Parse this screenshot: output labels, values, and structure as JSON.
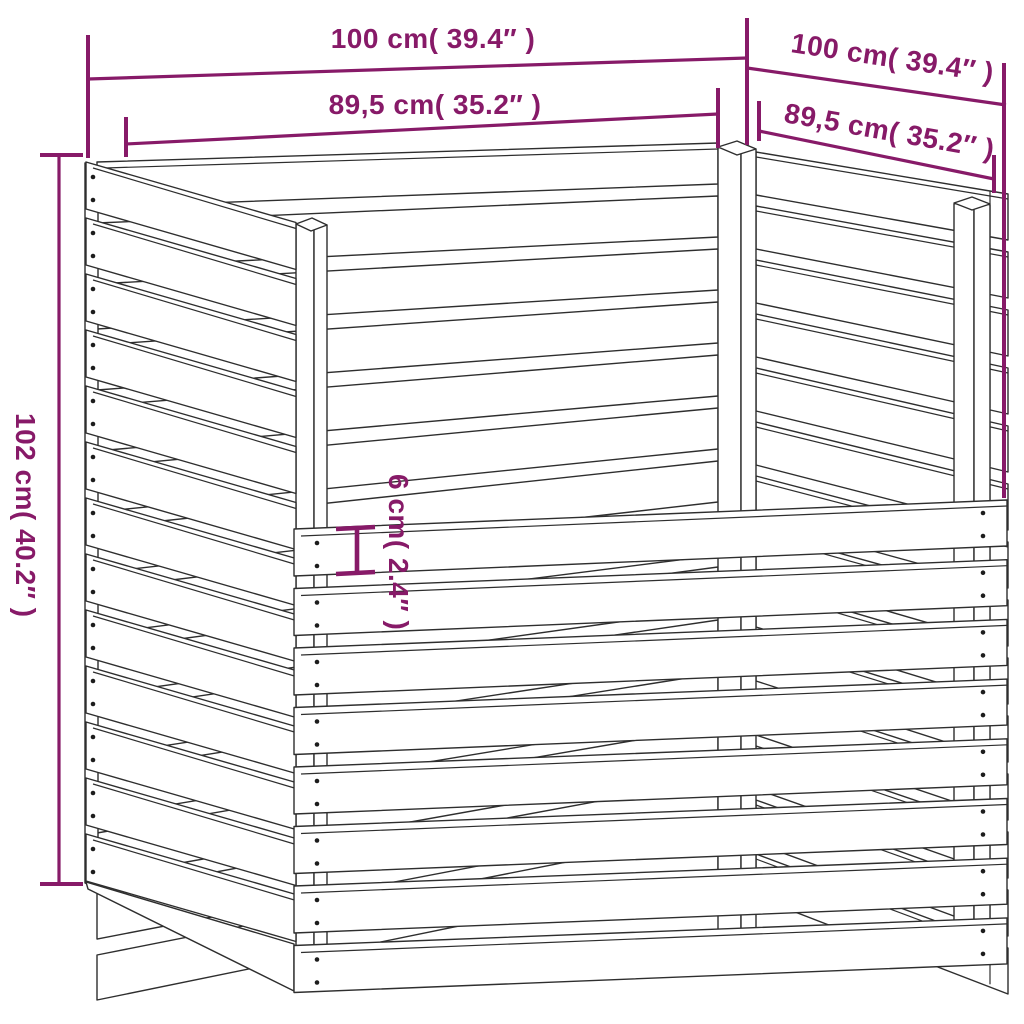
{
  "diagram": {
    "kind": "product-dimension-drawing",
    "subject": "wooden slatted composter, perspective line drawing",
    "background_color": "#ffffff",
    "colors": {
      "dimension_accent": "#871a68",
      "outline": "#2e2e2e"
    },
    "labels": {
      "back_width": "100 cm( 39.4″ )",
      "back_inner_width": "89,5 cm( 35.2″ )",
      "side_width": "100 cm( 39.4″ )",
      "side_inner_width": "89,5 cm( 35.2″ )",
      "height": "102 cm( 40.2″ )",
      "slat_width": "6 cm( 2.4″ )"
    }
  }
}
